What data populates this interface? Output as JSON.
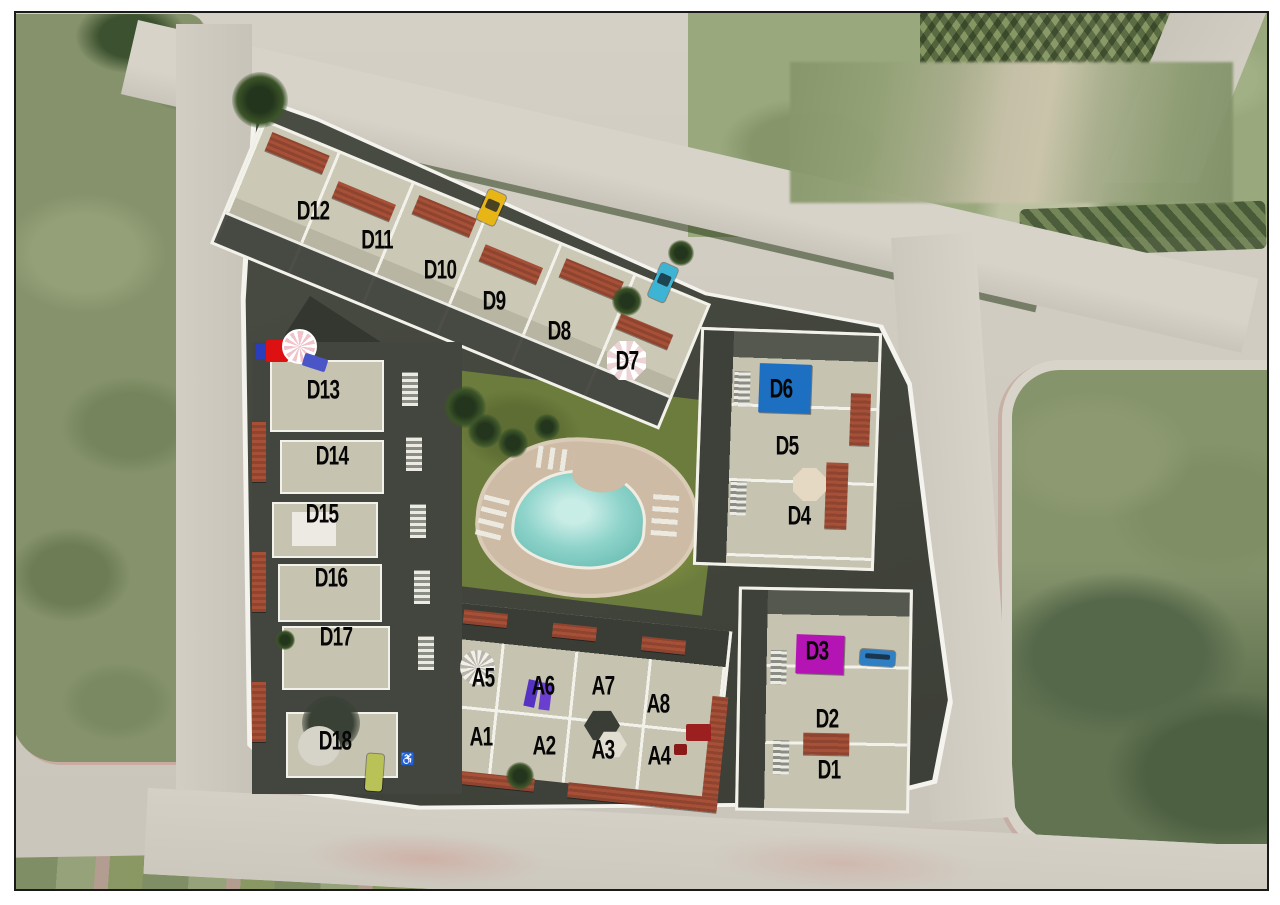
{
  "image_type": "aerial-site-plan",
  "site_plan": {
    "accessible_parking_glyph": "♿",
    "units_d": [
      {
        "id": "D1",
        "x": 829,
        "y": 770
      },
      {
        "id": "D2",
        "x": 827,
        "y": 719
      },
      {
        "id": "D3",
        "x": 817,
        "y": 651
      },
      {
        "id": "D4",
        "x": 799,
        "y": 516
      },
      {
        "id": "D5",
        "x": 787,
        "y": 446
      },
      {
        "id": "D6",
        "x": 781,
        "y": 389
      },
      {
        "id": "D7",
        "x": 627,
        "y": 361
      },
      {
        "id": "D8",
        "x": 559,
        "y": 331
      },
      {
        "id": "D9",
        "x": 494,
        "y": 301
      },
      {
        "id": "D10",
        "x": 440,
        "y": 270
      },
      {
        "id": "D11",
        "x": 377,
        "y": 240
      },
      {
        "id": "D12",
        "x": 313,
        "y": 211
      },
      {
        "id": "D13",
        "x": 323,
        "y": 390
      },
      {
        "id": "D14",
        "x": 332,
        "y": 456
      },
      {
        "id": "D15",
        "x": 322,
        "y": 514
      },
      {
        "id": "D16",
        "x": 331,
        "y": 578
      },
      {
        "id": "D17",
        "x": 336,
        "y": 637
      },
      {
        "id": "D18",
        "x": 335,
        "y": 741
      }
    ],
    "units_a": [
      {
        "id": "A1",
        "x": 481,
        "y": 737
      },
      {
        "id": "A2",
        "x": 544,
        "y": 746
      },
      {
        "id": "A3",
        "x": 603,
        "y": 750
      },
      {
        "id": "A4",
        "x": 659,
        "y": 756
      },
      {
        "id": "A5",
        "x": 483,
        "y": 678
      },
      {
        "id": "A6",
        "x": 543,
        "y": 686
      },
      {
        "id": "A7",
        "x": 603,
        "y": 686
      },
      {
        "id": "A8",
        "x": 658,
        "y": 704
      }
    ],
    "markers": [
      {
        "name": "blue-canopy-d6",
        "color": "#1d6fc2"
      },
      {
        "name": "magenta-canopy-d3",
        "color": "#b414b4"
      },
      {
        "name": "purple-loungers-a6",
        "color": "#5a35c2"
      },
      {
        "name": "red-umbrella",
        "color": "#dd1111"
      },
      {
        "name": "pink-striped-umbrella",
        "color": "#f0c2ca"
      },
      {
        "name": "yellow-car",
        "color": "#e7b515"
      },
      {
        "name": "cyan-car",
        "color": "#3db4d4"
      },
      {
        "name": "blue-car",
        "color": "#2f7fc4"
      },
      {
        "name": "lime-vehicle",
        "color": "#b9c257"
      }
    ],
    "amenity_colors": {
      "pool": "#8fd4cb",
      "lawn": "#6c7c3d",
      "deck": "#cdbba6",
      "roads": "#cdc9bf",
      "roof_terracotta": "#8f4430",
      "building": "#c6c3b1",
      "asphalt": "#45483f"
    }
  }
}
